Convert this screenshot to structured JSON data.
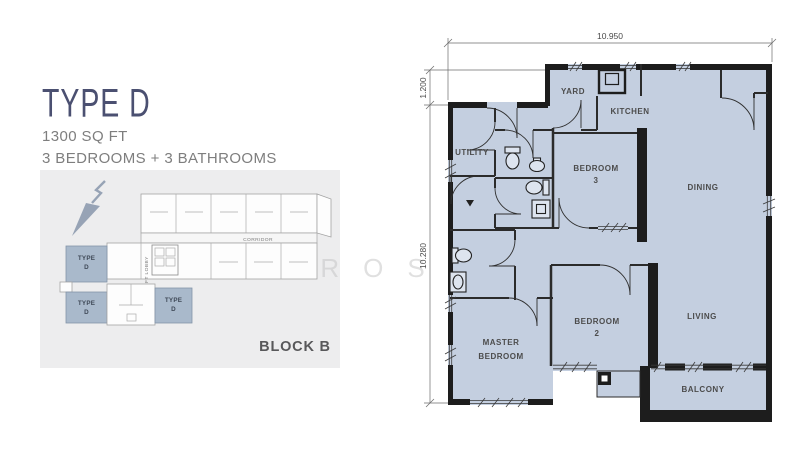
{
  "header": {
    "title": "TYPE D",
    "area": "1300 SQ FT",
    "config": "3 BEDROOMS + 3 BATHROOMS"
  },
  "keyplan": {
    "block_label": "BLOCK B",
    "corridor_label": "CORRIDOR",
    "lift_label": "LIFT LOBBY",
    "unit_label_line1": "TYPE",
    "unit_label_line2": "D"
  },
  "floorplan": {
    "dimensions": {
      "top": "10.950",
      "left_upper": "1.200",
      "left_lower": "10.280"
    },
    "rooms": {
      "yard": "YARD",
      "kitchen": "KITCHEN",
      "dining": "DINING",
      "utility": "UTILITY",
      "bedroom3_line1": "BEDROOM",
      "bedroom3_line2": "3",
      "bedroom2_line1": "BEDROOM",
      "bedroom2_line2": "2",
      "master_line1": "MASTER",
      "master_line2": "BEDROOM",
      "living": "LIVING",
      "balcony": "BALCONY"
    }
  },
  "watermark": "AMPROSE",
  "colors": {
    "accent": "#4b5071",
    "room_fill": "#c4cfe0",
    "keyplan_unit_fill": "#a9b9cb",
    "wall": "#1d1d1d",
    "card_bg": "#ededee",
    "label_text": "#4c4c4c"
  }
}
